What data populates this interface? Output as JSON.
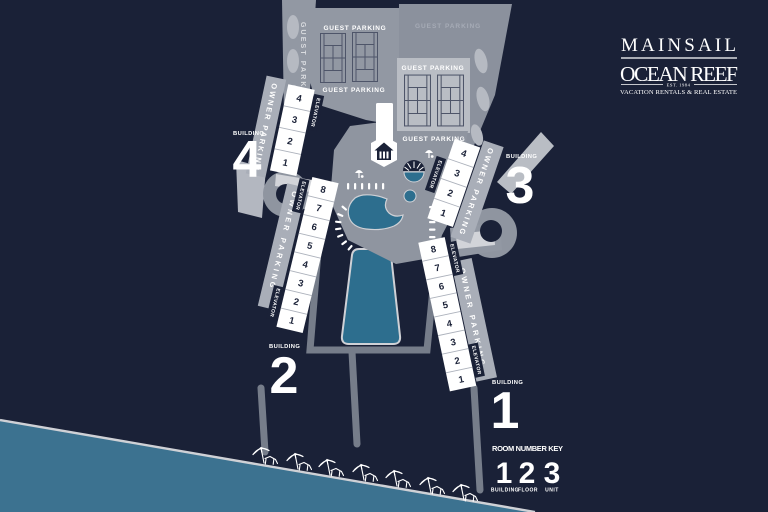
{
  "brand": {
    "name_top": "MAINSAIL",
    "name_main": "OCEAN REEF",
    "est": "EST. 1984",
    "tagline": "VACATION RENTALS & REAL ESTATE"
  },
  "labels": {
    "guest_parking": "GUEST PARKING",
    "owner_parking": "OWNER PARKING",
    "elevator": "ELEVATOR",
    "building": "BUILDING"
  },
  "buildings": [
    {
      "number": "1",
      "units": [
        "8",
        "7",
        "6",
        "5",
        "4",
        "3",
        "2",
        "1"
      ]
    },
    {
      "number": "2",
      "units": [
        "8",
        "7",
        "6",
        "5",
        "4",
        "3",
        "2",
        "1"
      ]
    },
    {
      "number": "3",
      "units": [
        "4",
        "3",
        "2",
        "1"
      ]
    },
    {
      "number": "4",
      "units": [
        "4",
        "3",
        "2",
        "1"
      ]
    }
  ],
  "room_number_key": {
    "title": "ROOM NUMBER KEY",
    "digits": [
      "1",
      "2",
      "3"
    ],
    "digit_labels": [
      "BUILDING",
      "FLOOR",
      "UNIT"
    ]
  },
  "colors": {
    "background": "#1a2137",
    "ocean": "#3c7290",
    "pool": "#2d6e8e",
    "parking_gray": "#9298a3",
    "light_gray": "#bcc0c7",
    "path_gray": "#767d8a",
    "white": "#ffffff"
  }
}
